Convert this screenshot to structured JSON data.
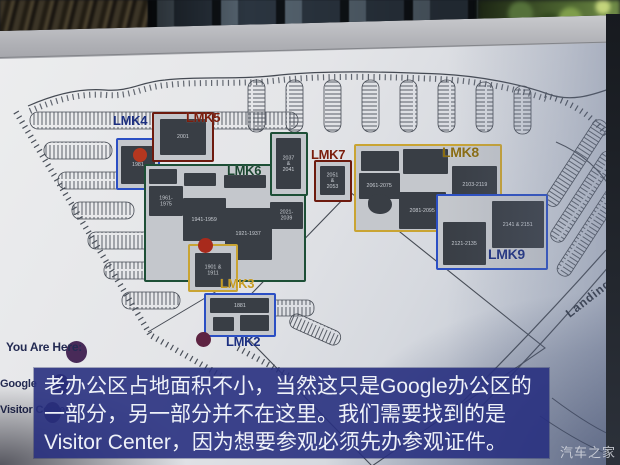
{
  "map": {
    "street_label": "Landing",
    "legend": {
      "you_are_here": "You Are Here:",
      "google": "Google",
      "visitor_center": "Visitor Center:"
    },
    "zones": [
      {
        "label": "LMK4",
        "buildings": [
          "1981"
        ]
      },
      {
        "label": "LMK5",
        "buildings": [
          "2001"
        ]
      },
      {
        "label": "LMK6",
        "buildings": [
          "1961-1975",
          "1941-1959",
          "1921-1937",
          "2021-2039",
          "2037 & 2041"
        ]
      },
      {
        "label": "LMK7",
        "buildings": [
          "2051 & 2053"
        ]
      },
      {
        "label": "LMK8",
        "buildings": [
          "2061-2075",
          "2081-2095",
          "2103-2119"
        ]
      },
      {
        "label": "LMK9",
        "buildings": [
          "2121-2135",
          "2141 & 2151"
        ]
      },
      {
        "label": "LMK3",
        "buildings": [
          "1901 & 1911"
        ]
      },
      {
        "label": "LMK2",
        "buildings": [
          "1881"
        ]
      }
    ],
    "colors": {
      "zone_blue": "#2b4fc4",
      "zone_maroon": "#6d1a0e",
      "zone_green": "#1d4f36",
      "zone_gold": "#c9a433",
      "label_blue": "#1c2f80",
      "label_maroon": "#7a1d0d",
      "label_green": "#1b4530",
      "label_gold": "#8a6c10",
      "label_gold_bright": "#c79d23",
      "marker_red": "#b5371f",
      "marker_purple": "#482a58",
      "marker_maroon": "#5e2442"
    }
  },
  "caption": {
    "lines": [
      "老办公区占地面积不小，当然这只是Google办公区的",
      "一部分，另一部分并不在这里。我们需要找到的是",
      "Visitor Center，因为想要参观必须先办参观证件。"
    ]
  },
  "watermark": "汽车之家"
}
